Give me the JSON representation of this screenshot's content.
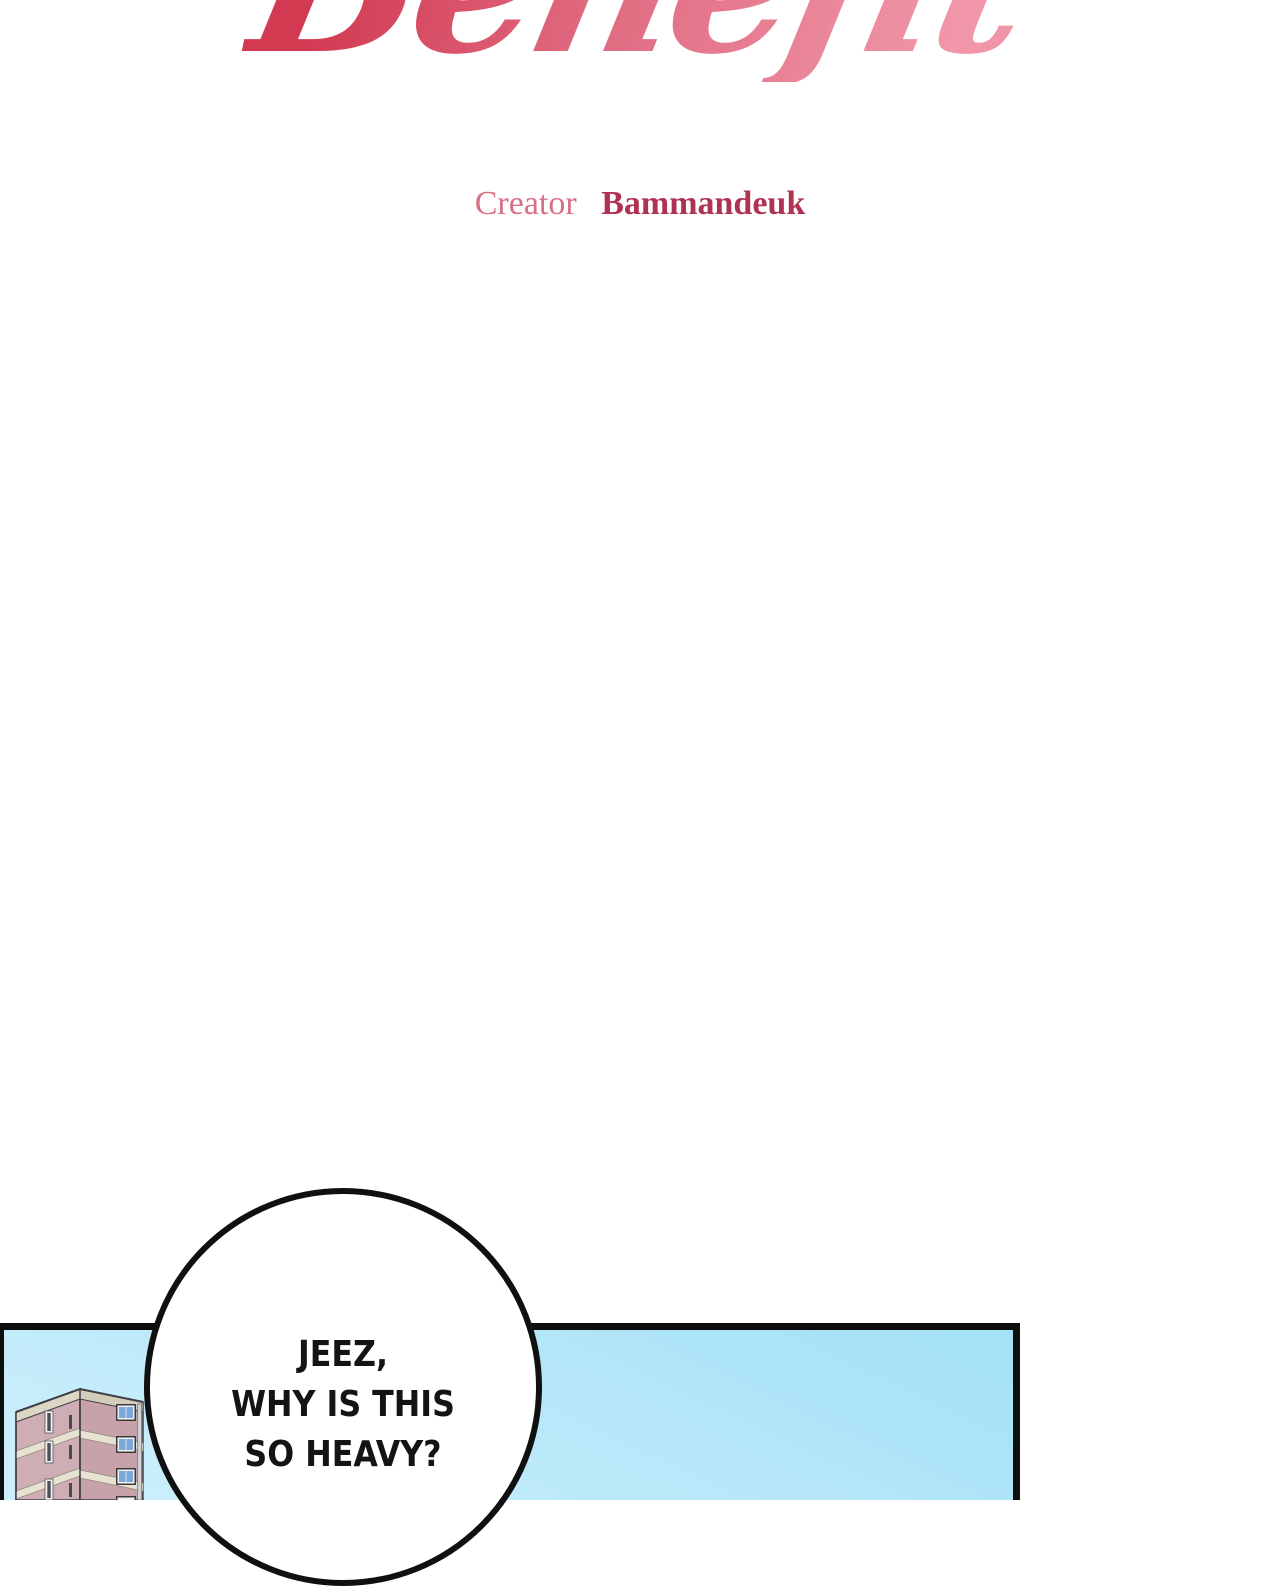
{
  "title": {
    "text": "Benefit",
    "gradient_left": "#d23a52",
    "gradient_right": "#f096a8"
  },
  "credit": {
    "label": "Creator",
    "name": "Bammandeuk",
    "label_color": "#d77086",
    "name_color": "#b03251"
  },
  "panel": {
    "sky_top": "#a5e1f7",
    "sky_bottom": "#cdeffb",
    "border_color": "#0d0d0d"
  },
  "speech_bubble": {
    "fill": "#ffffff",
    "border_color": "#101010",
    "lines": [
      "JEEZ,",
      "WHY IS THIS",
      "SO HEAVY?"
    ]
  },
  "building": {
    "wall_left_color": "#cfadb4",
    "wall_right_color": "#c7a2aa",
    "band_color": "#e8e2d3",
    "parapet_color": "#dcd7c5",
    "window_glass_color": "#7aa9da",
    "window_frame_color": "#f2f2f2",
    "outline_color": "#3f3f46",
    "pipe_color": "#ced1d5"
  }
}
